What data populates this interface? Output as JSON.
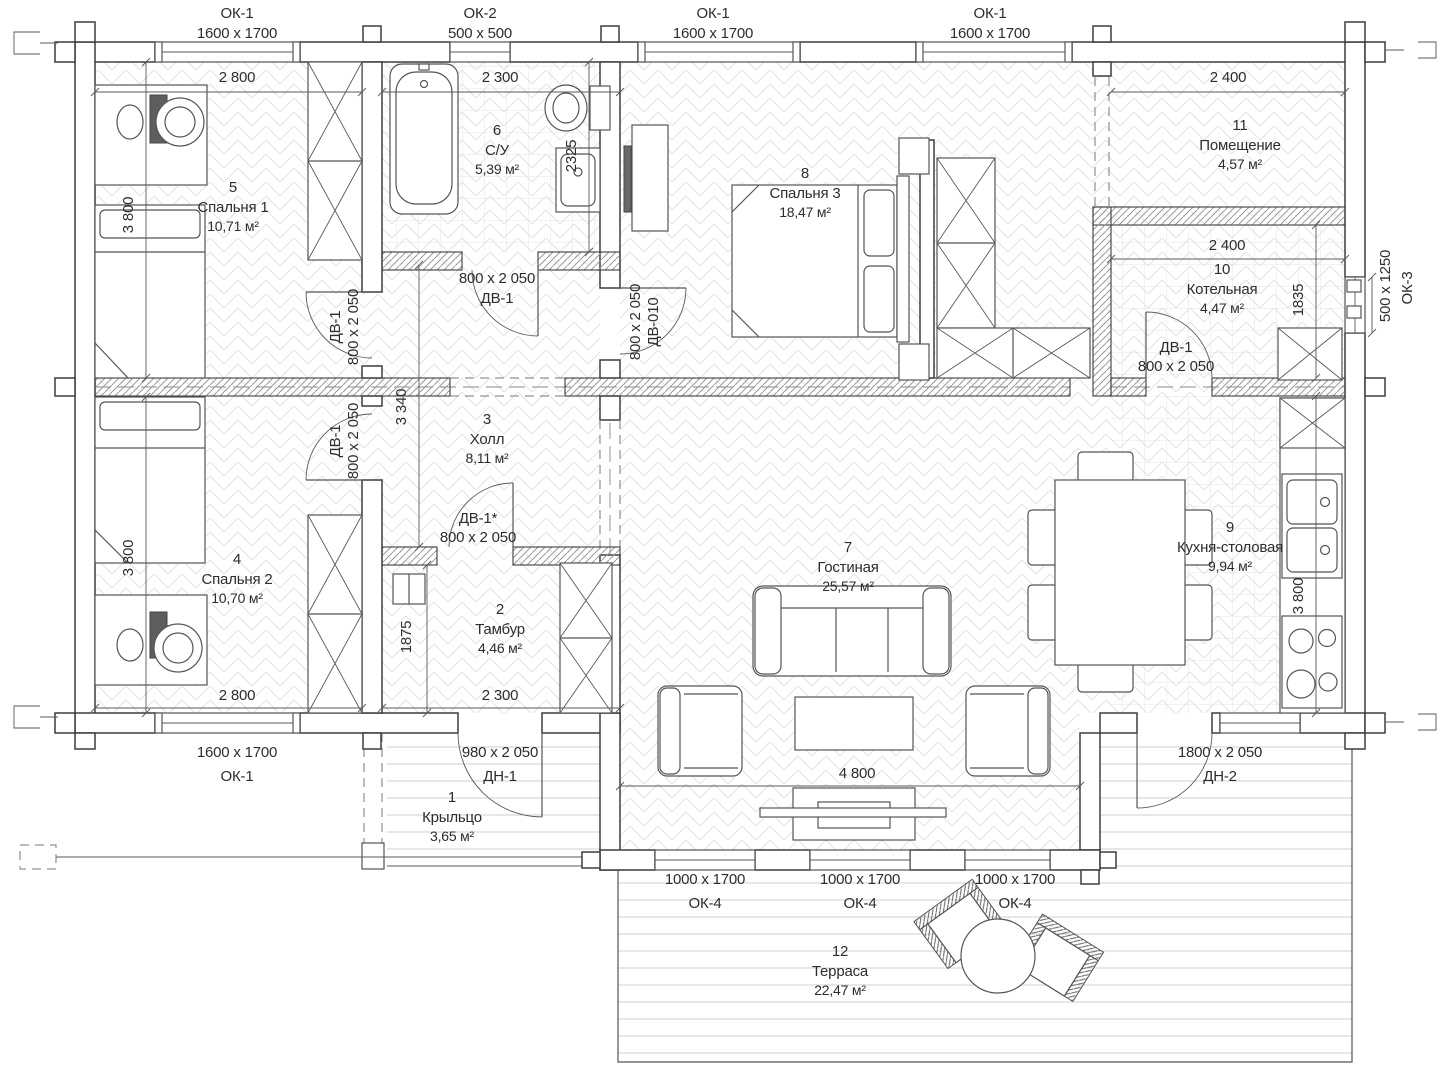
{
  "plan_texts": {
    "windows_top": [
      {
        "tag": "ОК-1",
        "size": "1600 x 1700"
      },
      {
        "tag": "ОК-2",
        "size": "500 x 500"
      },
      {
        "tag": "ОК-1",
        "size": "1600 x 1700"
      },
      {
        "tag": "ОК-1",
        "size": "1600 x 1700"
      }
    ],
    "openings_bottom": [
      {
        "size": "1600 x 1700",
        "tag": "ОК-1"
      },
      {
        "size": "980 x 2 050",
        "tag": "ДН-1"
      },
      {
        "size": "1800 x 2 050",
        "tag": "ДН-2"
      }
    ],
    "windows_terrace": [
      {
        "size": "1000 x 1700",
        "tag": "ОК-4"
      },
      {
        "size": "1000 x 1700",
        "tag": "ОК-4"
      },
      {
        "size": "1000 x 1700",
        "tag": "ОК-4"
      }
    ],
    "window_right": {
      "size": "500 x 1250",
      "tag": "ОК-3"
    },
    "doors": {
      "bathroom": {
        "size": "800 x 2 050",
        "tag": "ДВ-1"
      },
      "bedroom1": {
        "tag": "ДВ-1",
        "size": "800 x 2 050"
      },
      "bedroom2": {
        "tag": "ДВ-1",
        "size": "800 x 2 050"
      },
      "bedroom3": {
        "size": "800 x 2 050",
        "tag": "ДВ-010"
      },
      "vestibule": {
        "tag": "ДВ-1*",
        "size": "800 x 2 050"
      },
      "boiler": {
        "tag": "ДВ-1",
        "size": "800 x 2 050"
      }
    },
    "dims": {
      "bedroom1_w": "2 800",
      "bathroom_w": "2 300",
      "room11_w": "2 400",
      "boiler_w": "2 400",
      "bedroom2_w": "2 800",
      "vestibule_w": "2 300",
      "living_w": "4 800",
      "bedroom1_h": "3 800",
      "bedroom2_h": "3 800",
      "hall_h": "3 340",
      "vestibule_h": "1875",
      "bathroom_h": "2325",
      "boiler_h": "1835",
      "kitchen_h": "3 800"
    },
    "rooms": {
      "r1": {
        "num": "1",
        "name": "Крыльцо",
        "area": "3,65 м²"
      },
      "r2": {
        "num": "2",
        "name": "Тамбур",
        "area": "4,46 м²"
      },
      "r3": {
        "num": "3",
        "name": "Холл",
        "area": "8,11 м²"
      },
      "r4": {
        "num": "4",
        "name": "Спальня 2",
        "area": "10,70 м²"
      },
      "r5": {
        "num": "5",
        "name": "Спальня 1",
        "area": "10,71 м²"
      },
      "r6": {
        "num": "6",
        "name": "С/У",
        "area": "5,39 м²"
      },
      "r7": {
        "num": "7",
        "name": "Гостиная",
        "area": "25,57 м²"
      },
      "r8": {
        "num": "8",
        "name": "Спальня 3",
        "area": "18,47 м²"
      },
      "r9": {
        "num": "9",
        "name": "Кухня-столовая",
        "area": "9,94 м²"
      },
      "r10": {
        "num": "10",
        "name": "Котельная",
        "area": "4,47 м²"
      },
      "r11": {
        "num": "11",
        "name": "Помещение",
        "area": "4,57 м²"
      },
      "r12": {
        "num": "12",
        "name": "Терраса",
        "area": "22,47 м²"
      }
    }
  }
}
